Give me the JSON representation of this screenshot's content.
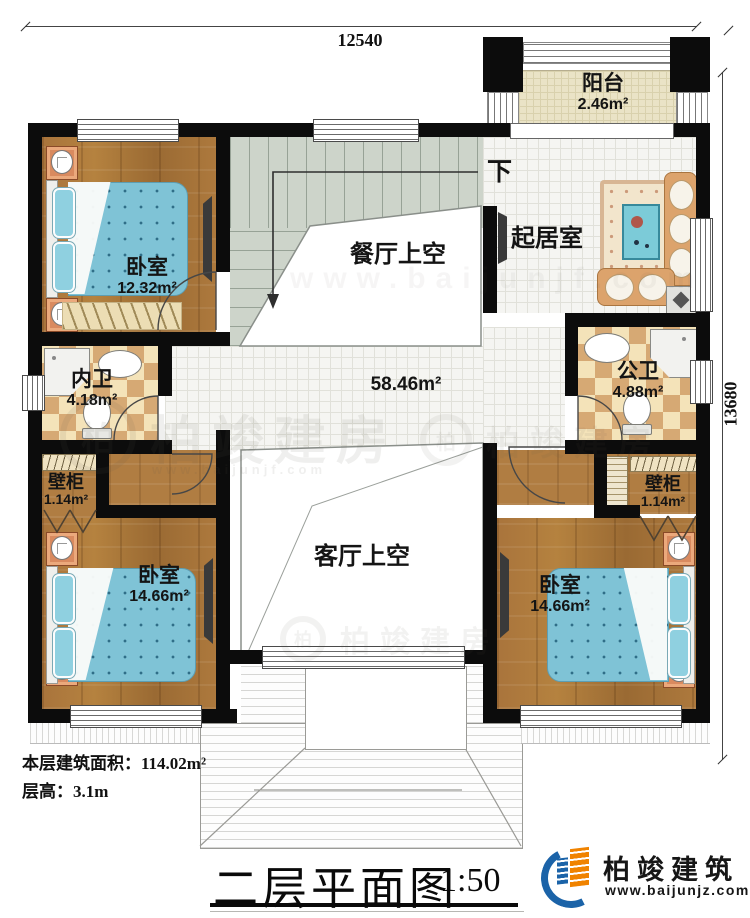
{
  "dimensions": {
    "top": "12540",
    "right": "13680"
  },
  "stairs": {
    "down": "下"
  },
  "rooms": {
    "balcony": {
      "name": "阳台",
      "area": "2.46m²"
    },
    "bedroom_tl": {
      "name": "卧室",
      "area": "12.32m²"
    },
    "dining_void": {
      "name": "餐厅上空"
    },
    "living": {
      "name": "起居室"
    },
    "hall": {
      "area": "58.46m²"
    },
    "bath_en_suite": {
      "name": "内卫",
      "area": "4.18m²"
    },
    "bath_public": {
      "name": "公卫",
      "area": "4.88m²"
    },
    "closet_left": {
      "name": "壁柜",
      "area": "1.14m²"
    },
    "closet_right": {
      "name": "壁柜",
      "area": "1.14m²"
    },
    "bedroom_bl": {
      "name": "卧室",
      "area": "14.66m²"
    },
    "bedroom_br": {
      "name": "卧室",
      "area": "14.66m²"
    },
    "living_void": {
      "name": "客厅上空"
    }
  },
  "info": {
    "area_label": "本层建筑面积：",
    "area_value": "114.02m²",
    "floor_height_label": "层高：",
    "floor_height_value": "3.1m"
  },
  "title": {
    "name": "二层平面图",
    "scale": "1:50"
  },
  "brand": {
    "name": "柏竣建筑",
    "website": "www.baijunjz.com"
  },
  "watermark": {
    "text": "柏竣建房",
    "ring_char": "柏",
    "website": "www.baijunjf.com"
  },
  "colors": {
    "wall": "#0c0c0c",
    "wood": "#a9743c",
    "stair": "#cdd4ca",
    "tile_checker": "#d6a974",
    "balcony": "#eae3c6",
    "bedding": "#7fc3d6",
    "brand_blue": "#1b63a8",
    "brand_orange": "#f08300"
  }
}
